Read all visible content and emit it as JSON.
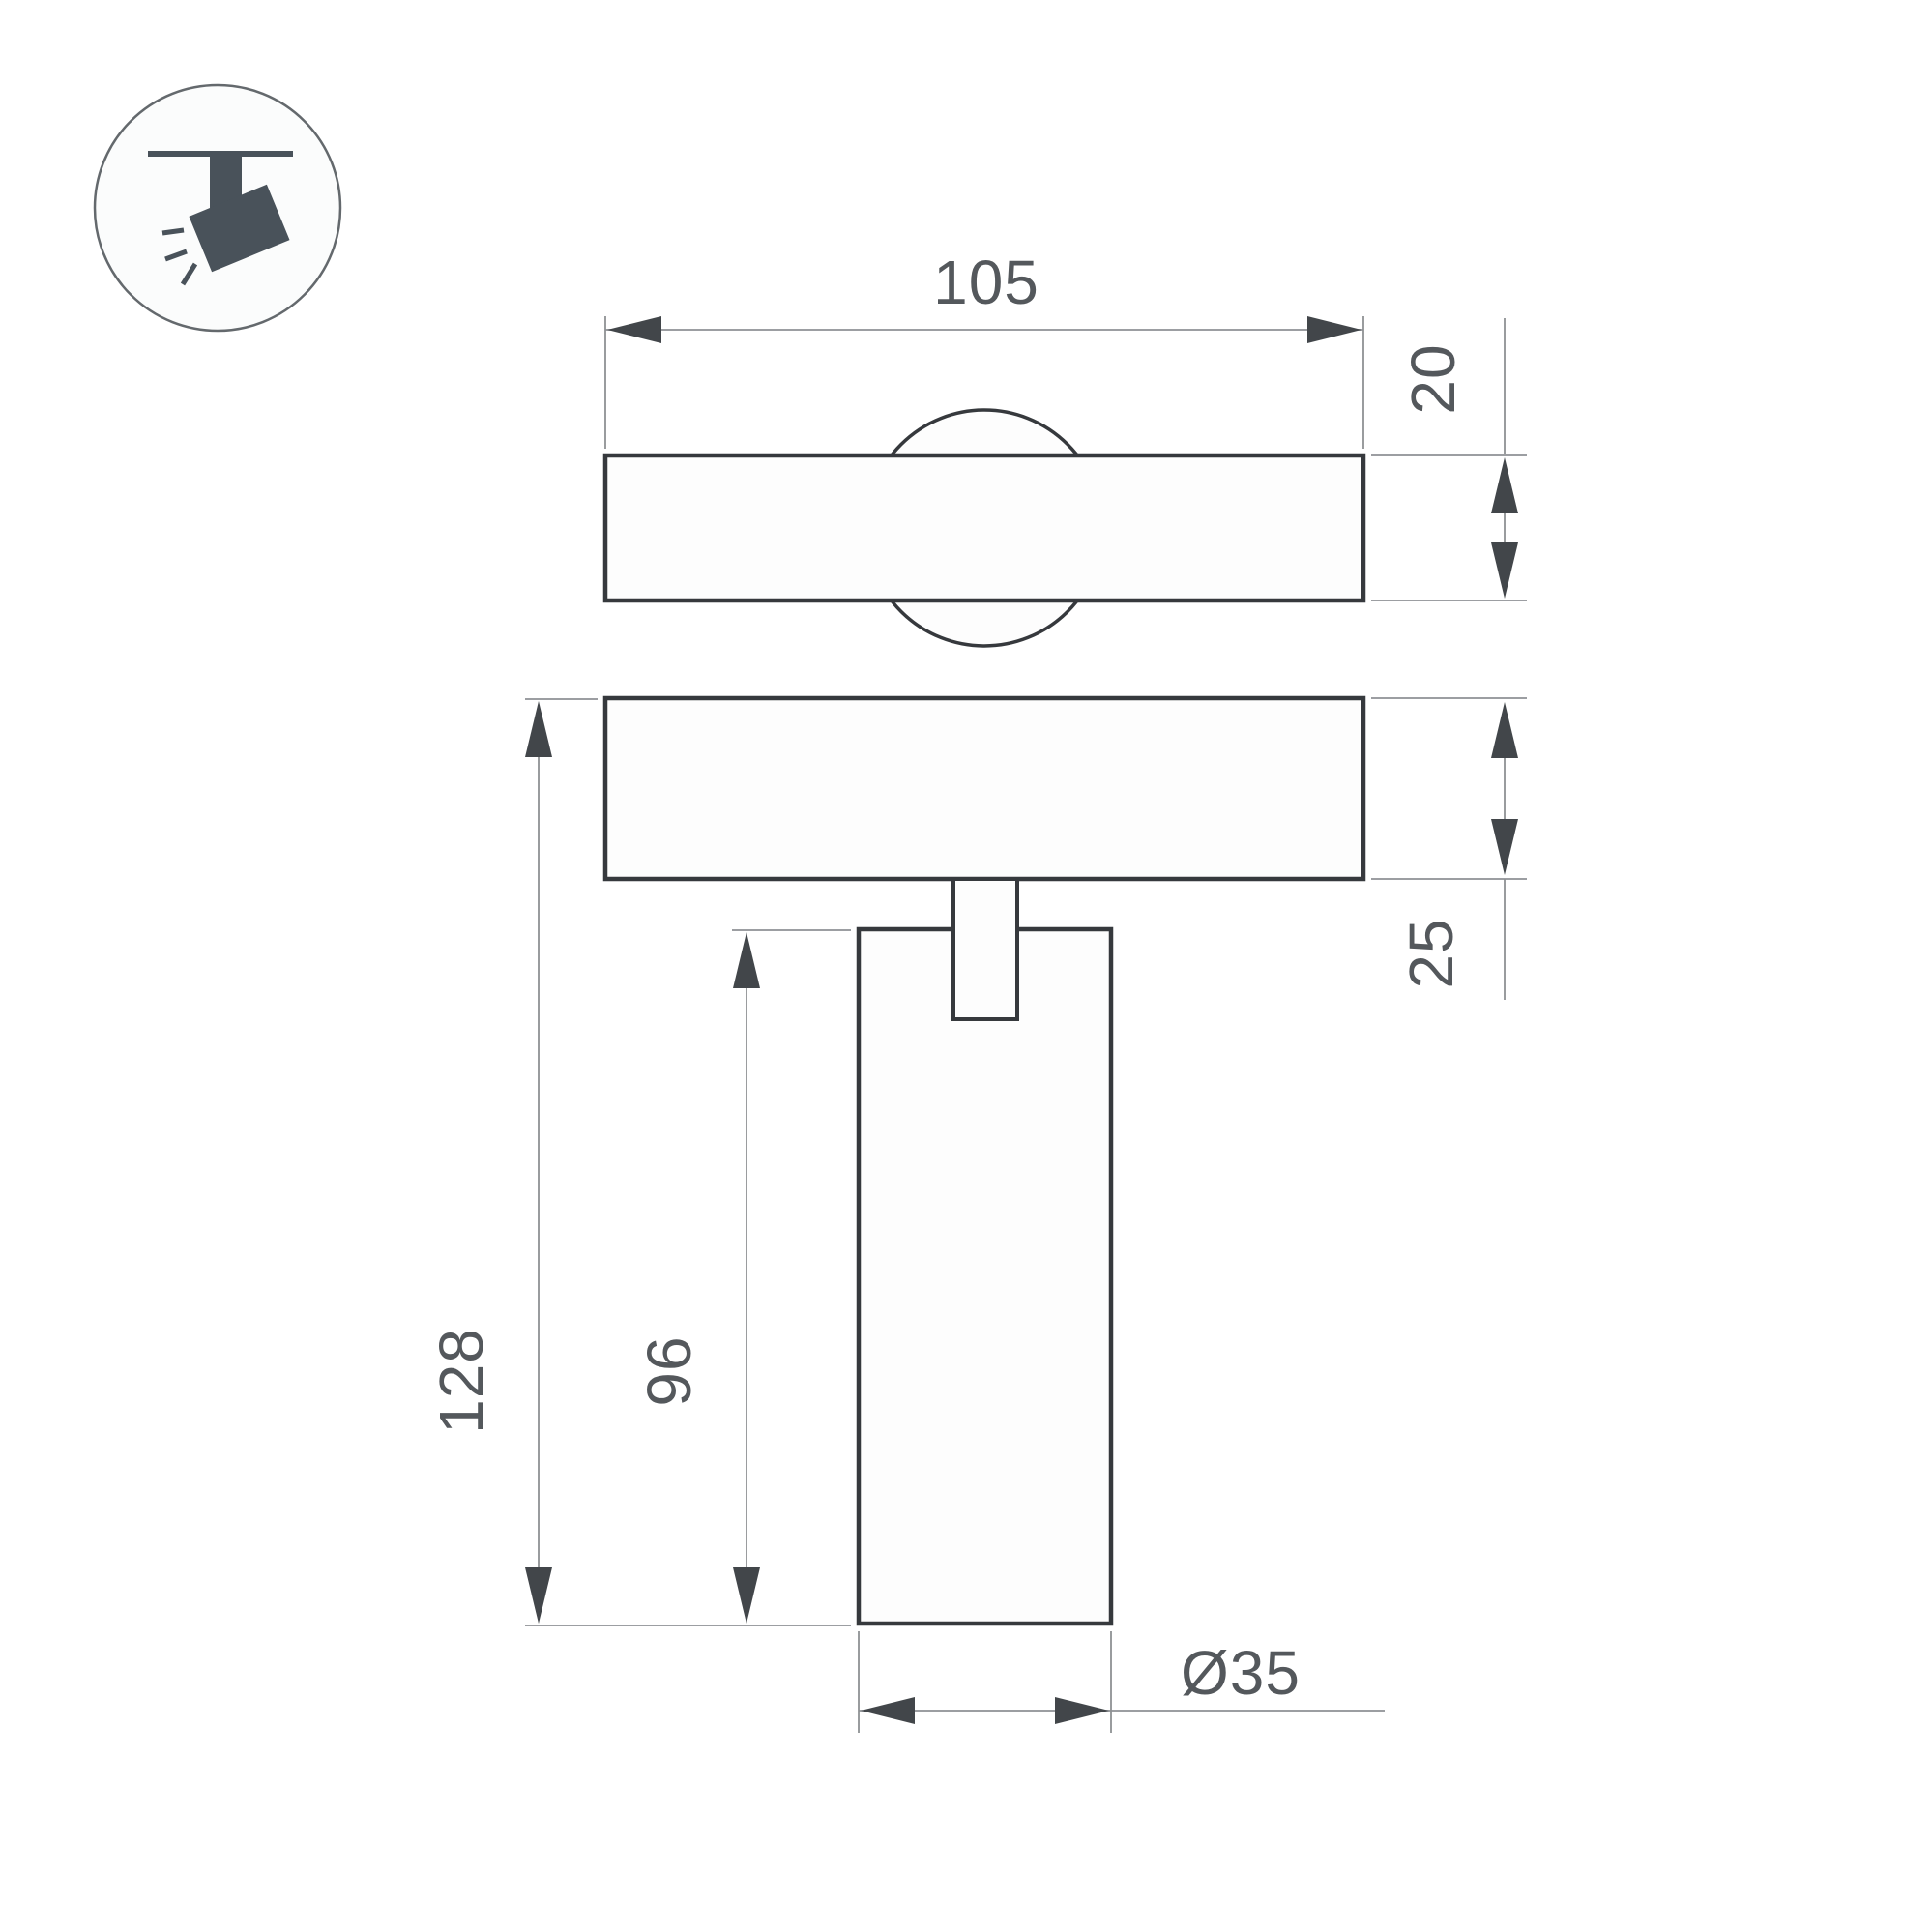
{
  "drawing": {
    "title": "track-spotlight-dimension-drawing",
    "views": {
      "top_view": "track plate with swivel joint",
      "side_view": "track plate with stem and cylindrical spotlight body"
    }
  },
  "icon": {
    "name": "ceiling-track-spotlight-icon",
    "color": "#49525a",
    "circle_stroke": "#64696d"
  },
  "dimensions": {
    "plate_width": {
      "value": "105",
      "unit": "mm",
      "orientation": "horizontal"
    },
    "plate_thickness": {
      "value": "20",
      "unit": "mm",
      "orientation": "vertical"
    },
    "base_thickness": {
      "value": "25",
      "unit": "mm",
      "orientation": "vertical"
    },
    "overall_height": {
      "value": "128",
      "unit": "mm",
      "orientation": "vertical"
    },
    "body_length": {
      "value": "96",
      "unit": "mm",
      "orientation": "vertical"
    },
    "body_diameter": {
      "value": "Ø35",
      "unit": "mm",
      "orientation": "horizontal"
    }
  },
  "colors": {
    "background": "#ffffff",
    "outline": "#36393d",
    "dim_line": "#8e9194",
    "arrow": "#42464a",
    "text": "#54585c",
    "icon": "#49525a"
  }
}
